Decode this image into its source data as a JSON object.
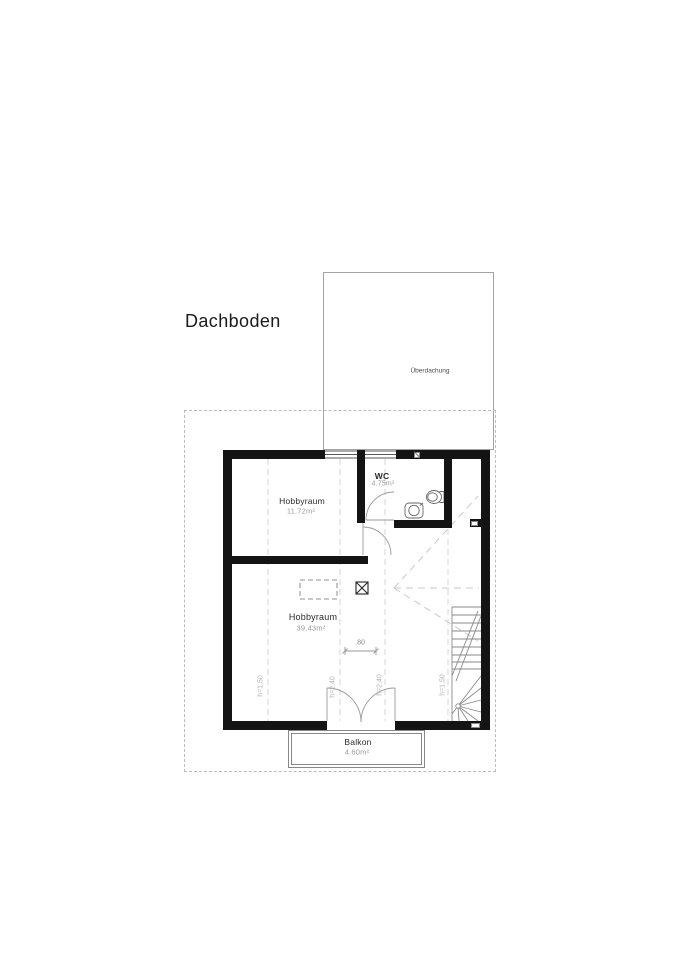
{
  "title": "Dachboden",
  "canopy": {
    "label": "Überdachung"
  },
  "rooms": {
    "hobby_small": {
      "name": "Hobbyraum",
      "area": "11.72m²"
    },
    "wc": {
      "name": "WC",
      "area": "4.75m²"
    },
    "hobby_large": {
      "name": "Hobbyraum",
      "area": "39.43m²"
    },
    "balcony": {
      "name": "Balkon",
      "area": "4.60m²"
    }
  },
  "annotations": {
    "door_width_dim": ".80",
    "height_marks": [
      "h=1,50",
      "h=2,40",
      "h=2,40",
      "h=1,50"
    ]
  },
  "colors": {
    "wall": "#141414",
    "thin_line": "#666666",
    "stair_line": "#8a8a8a",
    "boundary_dash": "#bcbcbc",
    "roof_dash": "#c9c9c9",
    "height_dash": "#d6d6d6",
    "label_dark": "#2a2a2a",
    "label_gray": "#9a9a9a",
    "background": "#ffffff"
  }
}
